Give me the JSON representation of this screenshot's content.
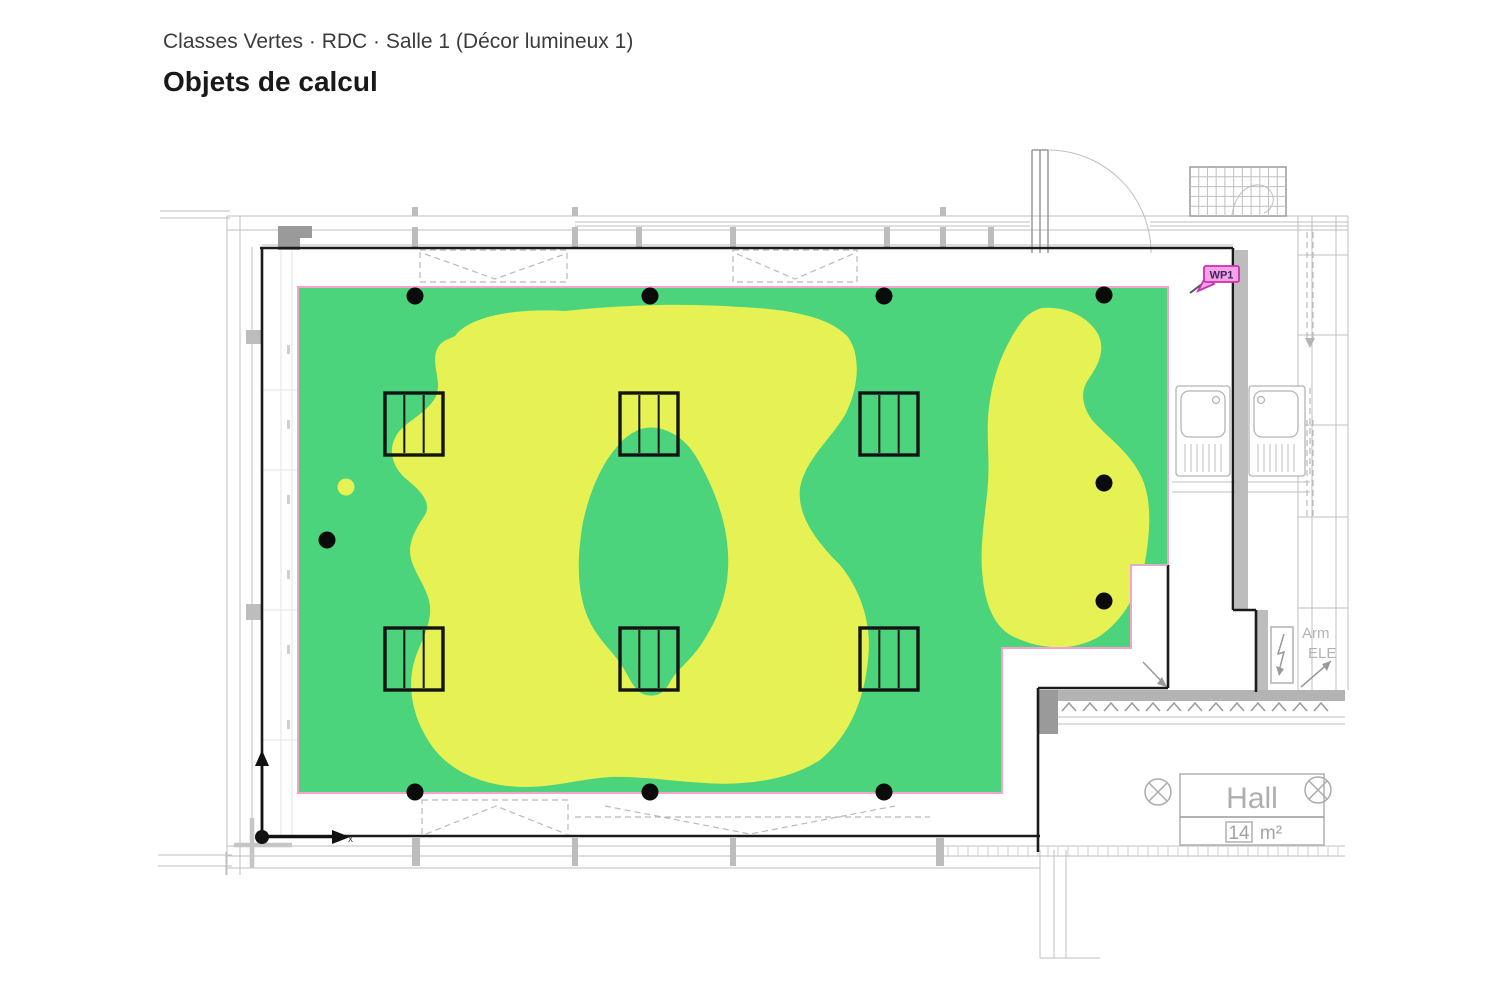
{
  "header": {
    "breadcrumb": "Classes Vertes · RDC · Salle 1 (Décor lumineux 1)",
    "title": "Objets de calcul"
  },
  "colors": {
    "surface_green": "#4bd47c",
    "contour_yellow": "#e6f253",
    "surface_border_pink": "#f5a2cf",
    "calc_point_black": "#0b0b0b",
    "wall_black": "#1b1b1b",
    "wall_gray": "#b5b5b5",
    "wp1_fill": "#f5a3e3",
    "wp1_border": "#c92fb4",
    "wp1_text": "#3d2264",
    "hall_text_gray": "#aeaeae"
  },
  "plan": {
    "wp1_label": "WP1",
    "hall": {
      "room_name": "Hall",
      "area_value": "14",
      "area_unit": "m²"
    },
    "elec_cabinet": {
      "line1": "Arm",
      "line2": "ELE"
    },
    "axis": {
      "x_label": "x"
    },
    "calc_points": [
      [
        415,
        296
      ],
      [
        650,
        296
      ],
      [
        884,
        296
      ],
      [
        1104,
        295
      ],
      [
        327,
        540
      ],
      [
        1104,
        483
      ],
      [
        1104,
        601
      ],
      [
        415,
        792
      ],
      [
        650,
        792
      ],
      [
        884,
        792
      ]
    ],
    "furniture_size": {
      "w": 58,
      "h": 62
    },
    "furniture_symbols": [
      [
        385,
        393
      ],
      [
        620,
        393
      ],
      [
        860,
        393
      ],
      [
        385,
        628
      ],
      [
        620,
        628
      ],
      [
        860,
        628
      ]
    ],
    "heatmap": {
      "surface_points": "298,287 1168,287 1168,565 1131,565 1131,648 1002,648 1002,793 298,793",
      "contour_main": "M 455,336 C 470,315 520,308 565,311 C 620,305 680,303 740,307 C 790,309 830,317 848,337 C 862,357 858,390 845,415 C 830,440 805,460 800,488 C 797,515 815,540 840,565 C 862,592 872,625 868,660 C 864,700 850,735 820,760 C 790,780 745,786 705,783 C 670,781 640,776 610,777 C 580,779 555,787 525,787 C 490,787 455,775 435,750 C 418,728 408,700 412,672 C 415,650 428,635 430,614 C 432,594 418,580 412,562 C 406,545 415,530 425,515 C 432,502 420,490 405,478 C 392,466 388,450 396,436 C 404,422 425,415 435,398 C 443,384 432,368 436,352 C 440,340 448,340 455,336 Z",
      "contour_hole": "M 638,430 C 658,422 684,434 698,460 C 714,488 726,520 728,552 C 730,588 720,615 704,640 C 692,660 678,668 670,682 C 664,694 656,697 646,695 C 634,692 630,678 622,666 C 612,650 598,640 589,620 C 576,592 577,556 583,522 C 590,490 602,464 616,448 C 624,438 630,434 638,430 Z",
      "contour_right": "M 1042,308 C 1065,306 1088,316 1098,334 C 1106,350 1098,366 1088,380 C 1080,392 1082,406 1092,420 C 1108,438 1130,452 1142,478 C 1152,502 1150,530 1146,556 C 1141,588 1126,618 1100,636 C 1074,652 1040,650 1012,636 C 992,625 984,600 982,570 C 980,540 986,512 988,482 C 990,455 985,430 990,400 C 994,372 1005,345 1020,324 C 1026,315 1034,310 1042,308 Z",
      "contour_spot": "M 337.5,487 a 8.5,8.5 0 1 0 17,0 a 8.5,8.5 0 1 0 -17,0 Z"
    }
  }
}
